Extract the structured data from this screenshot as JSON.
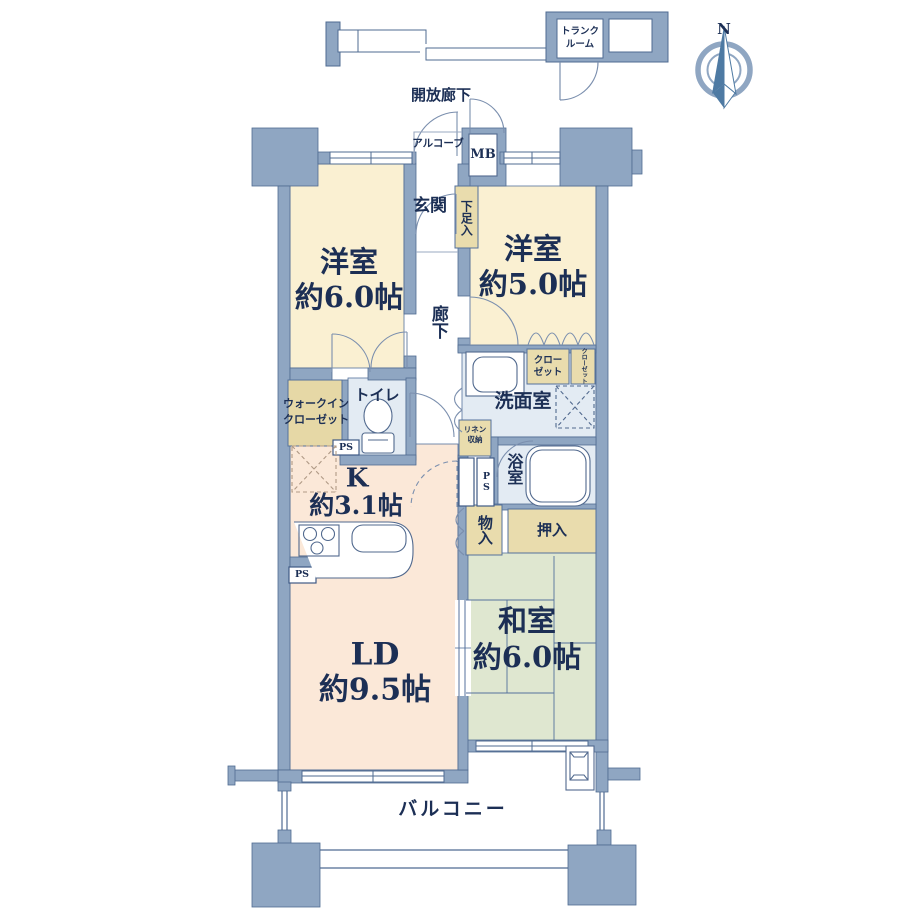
{
  "compass": {
    "north": "N"
  },
  "rooms": {
    "bedroom_west": {
      "name": "洋室",
      "size": "約6.0帖"
    },
    "bedroom_east": {
      "name": "洋室",
      "size": "約5.0帖"
    },
    "kitchen": {
      "name": "K",
      "size": "約3.1帖"
    },
    "living_dining": {
      "name": "LD",
      "size": "約9.5帖"
    },
    "japanese_room": {
      "name": "和室",
      "size": "約6.0帖"
    }
  },
  "labels": {
    "open_corridor": "開放廊下",
    "trunk_room_line1": "トランク",
    "trunk_room_line2": "ルーム",
    "alcove": "アルコーブ",
    "meter_box": "MB",
    "entrance": "玄関",
    "shoe_cabinet": "下足入",
    "corridor": "廊下",
    "toilet": "トイレ",
    "walk_in_closet_line1": "ウォークイン",
    "walk_in_closet_line2": "クローゼット",
    "washroom": "洗面室",
    "bathroom": "浴室",
    "linen_line1": "リネン",
    "linen_line2": "収納",
    "closet_line1": "クロー",
    "closet_line2": "ゼット",
    "closet_small": "クローゼット",
    "pipe_space": "PS",
    "storage": "物入",
    "oshiire": "押入",
    "balcony": "バルコニー"
  },
  "colors": {
    "wall": "#8FA6C2",
    "wall_outline": "#4F6B92",
    "western_room": "#FAF0D2",
    "kitchen_living": "#FBE8D8",
    "japanese_room": "#DFE7D0",
    "wet_area": "#E3EBF3",
    "storage_tan": "#E9DCAD",
    "text": "#1C2F55"
  }
}
